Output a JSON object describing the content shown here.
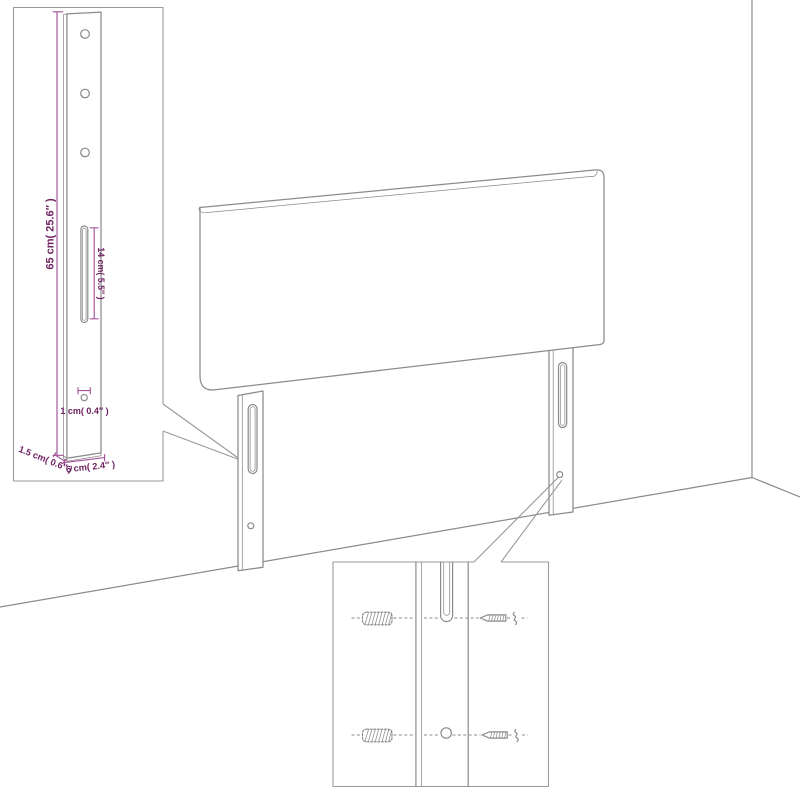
{
  "theme": {
    "background": "#ffffff",
    "line_gray": "#8b8b8b",
    "box_gray": "#9a9a9a",
    "dim_line_purple": "#a4549a",
    "dim_text_purple": "#6f2361"
  },
  "inset_bracket_view": {
    "dim_height": "65 cm( 25.6″ )",
    "dim_slot_length": "14 cm( 5.5″ )",
    "dim_hole_diameter": "1 cm( 0.4″ )",
    "dim_thickness": "1.5 cm( 0.6″ )",
    "dim_width": "6 cm( 2.4″ )"
  }
}
